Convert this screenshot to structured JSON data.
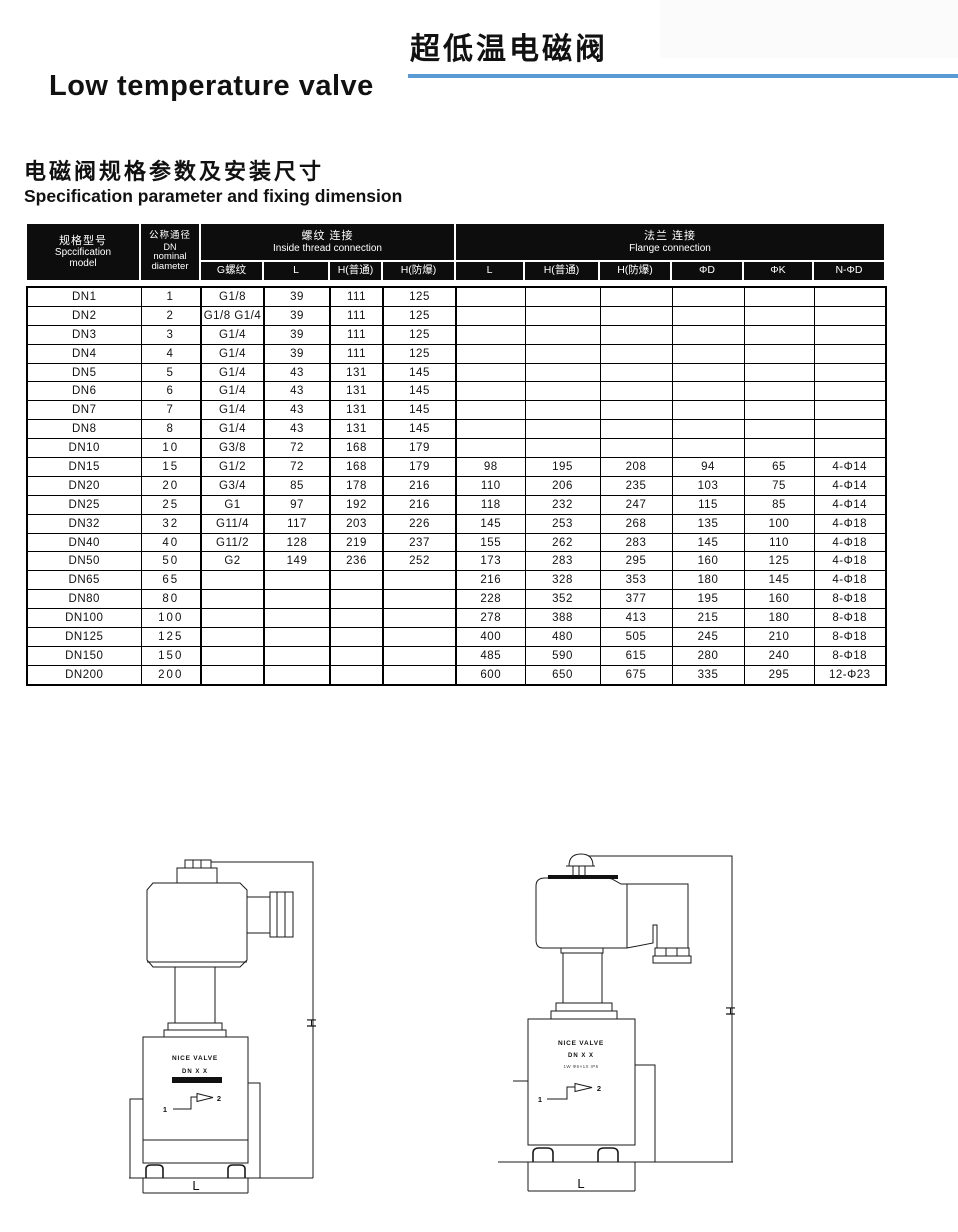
{
  "page": {
    "title_zh": "超低温电磁阀",
    "title_en": "Low temperature valve",
    "section_title_zh": "电磁阀规格参数及安装尺寸",
    "section_title_en": "Specification parameter and fixing dimension",
    "accent_color": "#5b9bd5"
  },
  "table": {
    "header": {
      "model_zh": "规格型号",
      "model_en1": "Spccification",
      "model_en2": "model",
      "dn_zh": "公称通径",
      "dn_code": "DN",
      "dn_en1": "nominal",
      "dn_en2": "diameter",
      "thread_zh": "螺纹 连接",
      "thread_en": "Inside thread connection",
      "flange_zh": "法兰 连接",
      "flange_en": "Flange connection",
      "sub": [
        "G螺纹",
        "L",
        "H(普通)",
        "H(防爆)",
        "L",
        "H(普通)",
        "H(防爆)",
        "ΦD",
        "ΦK",
        "N-ΦD"
      ]
    },
    "rows": [
      [
        "DN1",
        "1",
        "G1/8",
        "39",
        "111",
        "125",
        "",
        "",
        "",
        "",
        "",
        ""
      ],
      [
        "DN2",
        "2",
        "G1/8 G1/4",
        "39",
        "111",
        "125",
        "",
        "",
        "",
        "",
        "",
        ""
      ],
      [
        "DN3",
        "3",
        "G1/4",
        "39",
        "111",
        "125",
        "",
        "",
        "",
        "",
        "",
        ""
      ],
      [
        "DN4",
        "4",
        "G1/4",
        "39",
        "111",
        "125",
        "",
        "",
        "",
        "",
        "",
        ""
      ],
      [
        "DN5",
        "5",
        "G1/4",
        "43",
        "131",
        "145",
        "",
        "",
        "",
        "",
        "",
        ""
      ],
      [
        "DN6",
        "6",
        "G1/4",
        "43",
        "131",
        "145",
        "",
        "",
        "",
        "",
        "",
        ""
      ],
      [
        "DN7",
        "7",
        "G1/4",
        "43",
        "131",
        "145",
        "",
        "",
        "",
        "",
        "",
        ""
      ],
      [
        "DN8",
        "8",
        "G1/4",
        "43",
        "131",
        "145",
        "",
        "",
        "",
        "",
        "",
        ""
      ],
      [
        "DN10",
        "10",
        "G3/8",
        "72",
        "168",
        "179",
        "",
        "",
        "",
        "",
        "",
        ""
      ],
      [
        "DN15",
        "15",
        "G1/2",
        "72",
        "168",
        "179",
        "98",
        "195",
        "208",
        "94",
        "65",
        "4-Φ14"
      ],
      [
        "DN20",
        "20",
        "G3/4",
        "85",
        "178",
        "216",
        "110",
        "206",
        "235",
        "103",
        "75",
        "4-Φ14"
      ],
      [
        "DN25",
        "25",
        "G1",
        "97",
        "192",
        "216",
        "118",
        "232",
        "247",
        "115",
        "85",
        "4-Φ14"
      ],
      [
        "DN32",
        "32",
        "G11/4",
        "117",
        "203",
        "226",
        "145",
        "253",
        "268",
        "135",
        "100",
        "4-Φ18"
      ],
      [
        "DN40",
        "40",
        "G11/2",
        "128",
        "219",
        "237",
        "155",
        "262",
        "283",
        "145",
        "110",
        "4-Φ18"
      ],
      [
        "DN50",
        "50",
        "G2",
        "149",
        "236",
        "252",
        "173",
        "283",
        "295",
        "160",
        "125",
        "4-Φ18"
      ],
      [
        "DN65",
        "65",
        "",
        "",
        "",
        "",
        "216",
        "328",
        "353",
        "180",
        "145",
        "4-Φ18"
      ],
      [
        "DN80",
        "80",
        "",
        "",
        "",
        "",
        "228",
        "352",
        "377",
        "195",
        "160",
        "8-Φ18"
      ],
      [
        "DN100",
        "100",
        "",
        "",
        "",
        "",
        "278",
        "388",
        "413",
        "215",
        "180",
        "8-Φ18"
      ],
      [
        "DN125",
        "125",
        "",
        "",
        "",
        "",
        "400",
        "480",
        "505",
        "245",
        "210",
        "8-Φ18"
      ],
      [
        "DN150",
        "150",
        "",
        "",
        "",
        "",
        "485",
        "590",
        "615",
        "280",
        "240",
        "8-Φ18"
      ],
      [
        "DN200",
        "200",
        "",
        "",
        "",
        "",
        "600",
        "650",
        "675",
        "335",
        "295",
        "12-Φ23"
      ]
    ]
  },
  "diagram_left": {
    "brand": "NICE VALVE",
    "model": "DN X X",
    "dim_h": "H",
    "dim_l": "L",
    "port_in": "1",
    "port_out": "2"
  },
  "diagram_right": {
    "brand": "NICE VALVE",
    "model": "DN X X",
    "spec_line": "1W Φ6×1X IP5",
    "dim_h": "H",
    "dim_l": "L",
    "port_in": "1",
    "port_out": "2"
  }
}
